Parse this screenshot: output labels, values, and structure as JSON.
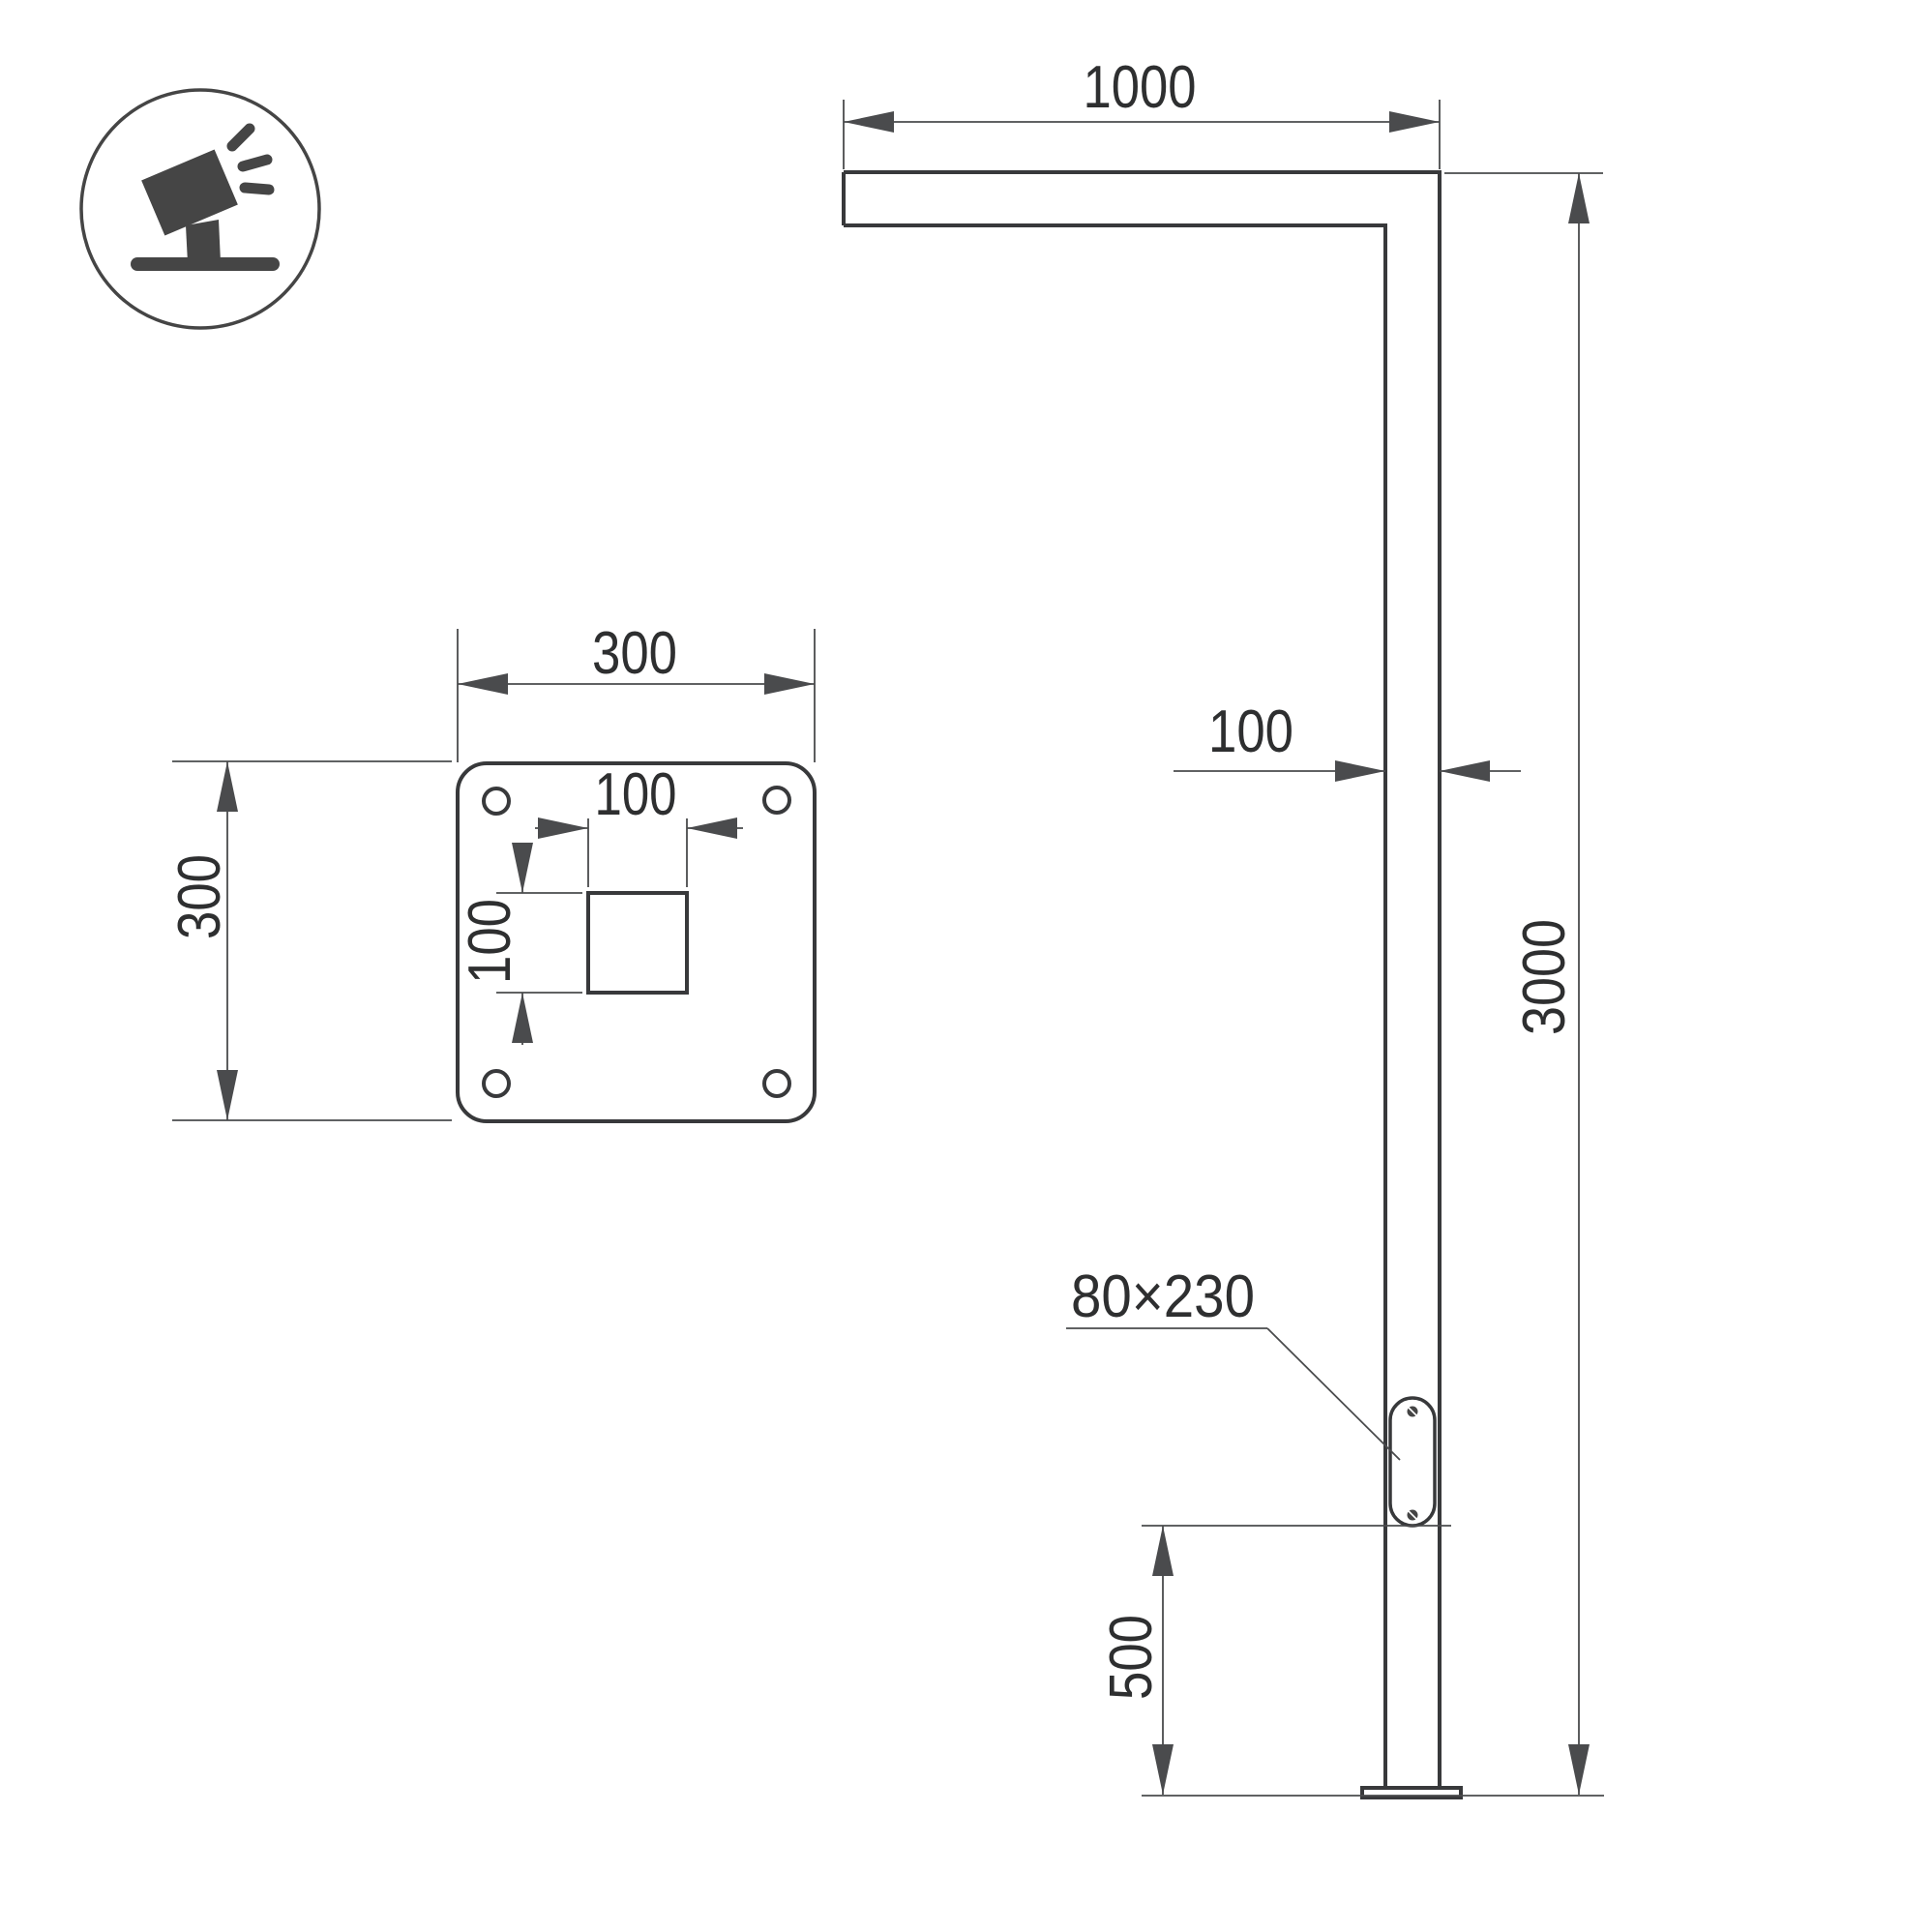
{
  "colors": {
    "background": "#ffffff",
    "line_thick": "#38393b",
    "line_thin": "#4a4b4d",
    "text_color": "#2e2f30",
    "icon_color": "#454545"
  },
  "icon": {
    "name": "tilted-floodlight-icon"
  },
  "pole_view": {
    "arm_length_label": "1000",
    "pole_width_label": "100",
    "pole_height_label": "3000",
    "door_label": "80×230",
    "door_bottom_height_label": "500"
  },
  "plate_view": {
    "width_label": "300",
    "height_label": "300",
    "hole_width_label": "100",
    "hole_height_label": "100"
  }
}
